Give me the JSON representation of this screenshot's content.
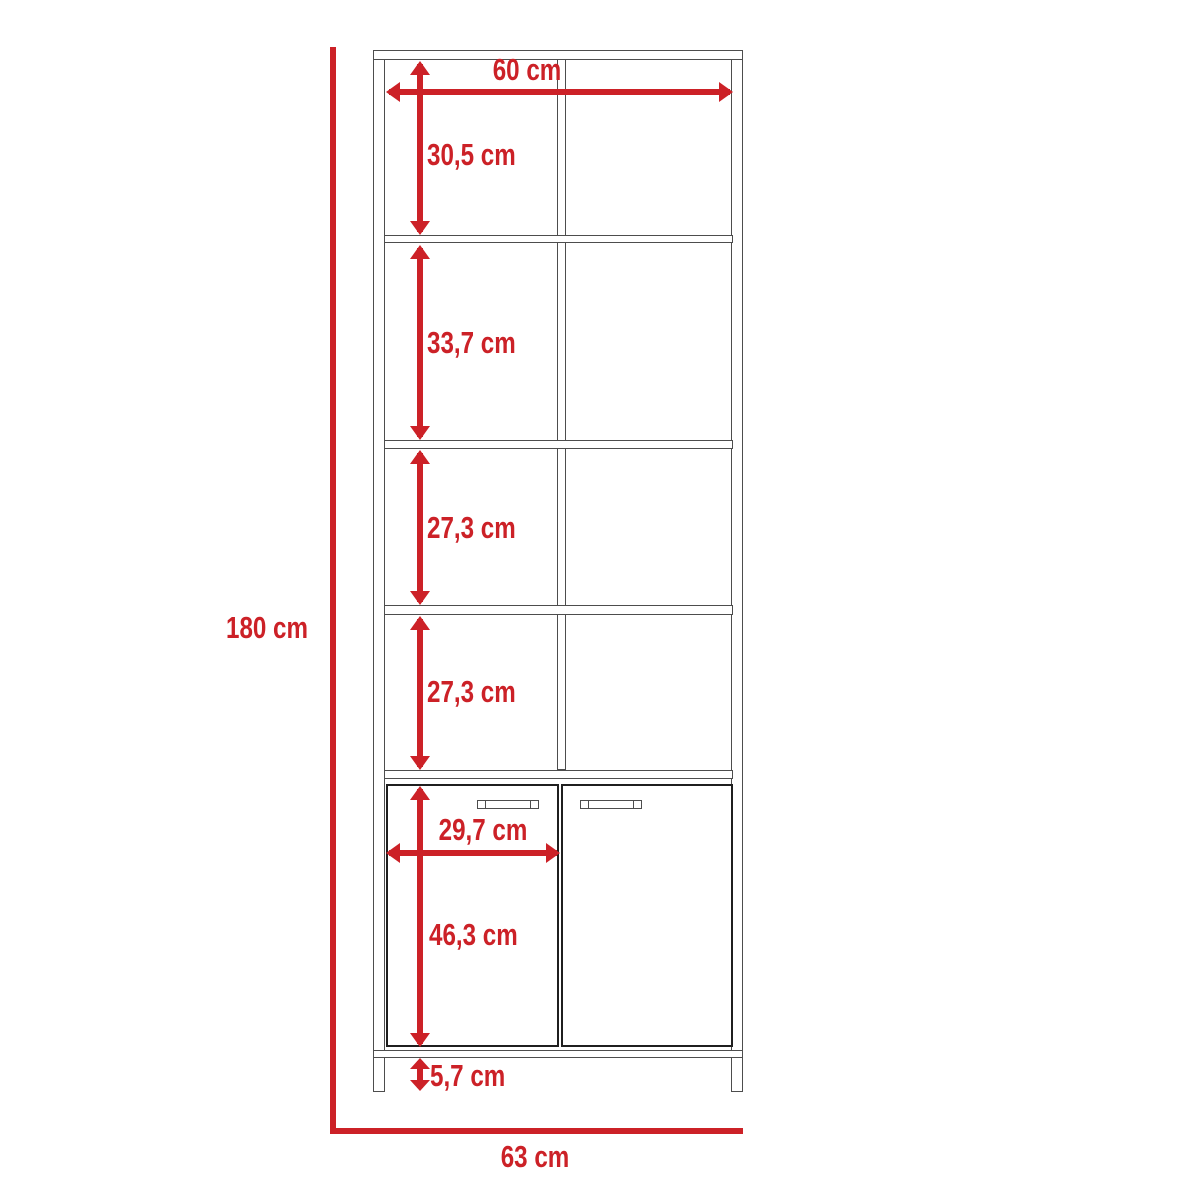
{
  "diagram": {
    "type": "furniture-dimension-drawing",
    "subject": "tall bookcase with four open shelf compartments and two lower doors, front elevation",
    "unit": "cm"
  },
  "colors": {
    "accent": "#cc2127",
    "line": "#4d4d4d",
    "doorline": "#1f1f1f",
    "bg": "#ffffff"
  },
  "labels": {
    "inner_width": "60 cm",
    "compartment_1_height": "30,5 cm",
    "compartment_2_height": "33,7 cm",
    "compartment_3_height": "27,3 cm",
    "compartment_4_height": "27,3 cm",
    "door_width": "29,7 cm",
    "door_height": "46,3 cm",
    "leg_height": "5,7 cm",
    "overall_height": "180 cm",
    "overall_width": "63 cm"
  }
}
